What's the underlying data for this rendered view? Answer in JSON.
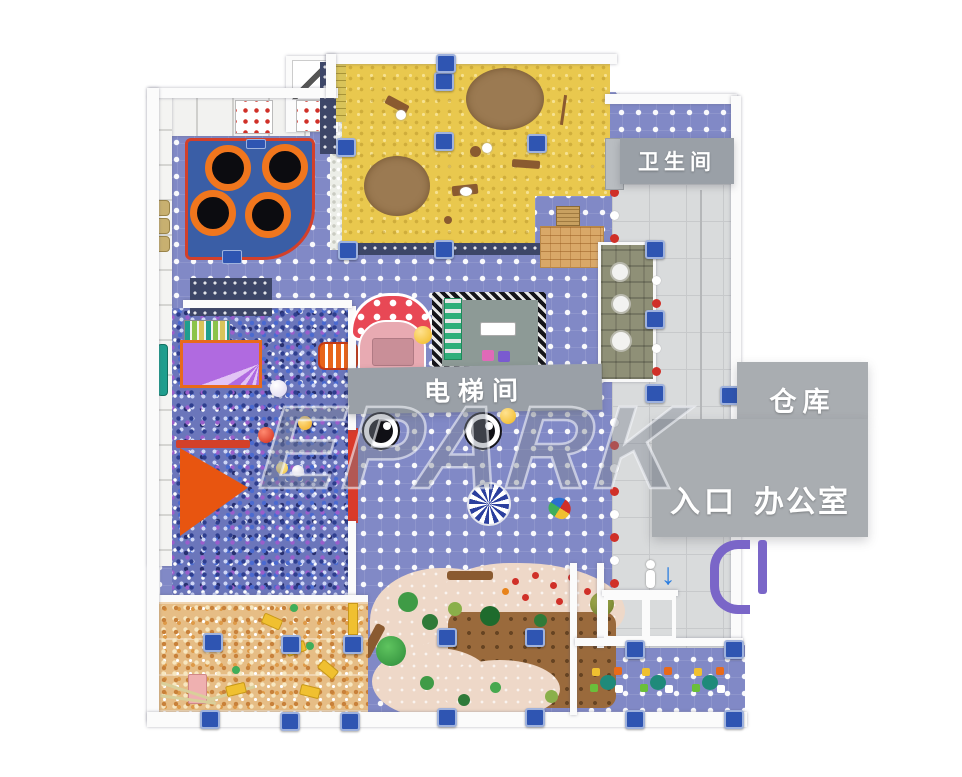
{
  "watermark": "EPARK",
  "rooms": {
    "restroom": {
      "label": "卫生间"
    },
    "elevator": {
      "label": "电梯间"
    },
    "warehouse": {
      "label": "仓库"
    },
    "entrance": {
      "label": "入口"
    },
    "office": {
      "label": "办公室"
    }
  },
  "colors": {
    "floor_dot_blue": "#8189c6",
    "sand_yellow": "#e9c84e",
    "sand_pit_brown": "#9b7a52",
    "trampoline_mat_blue": "#3a5ea6",
    "trampoline_ring_orange": "#f0761d",
    "gray_band": "#9aa0a7",
    "gray_block": "#a9adb1",
    "corridor_tile": "#d9dbdc",
    "ball_pit_base": "#6b76bb",
    "candy_base": "#e6bd85",
    "nature_pink": "#eed8c8",
    "nature_brown": "#9a6a3c",
    "gate_purple": "#7a66c8",
    "pillar_blue": "#2f55b2"
  }
}
